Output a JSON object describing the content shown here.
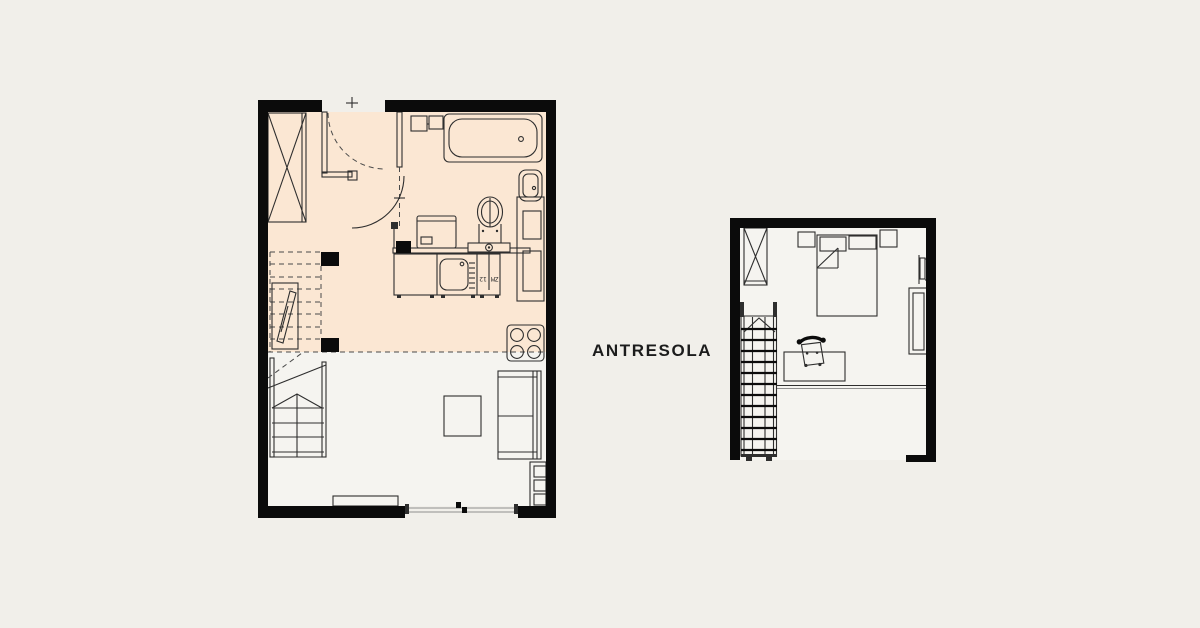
{
  "labels": {
    "mezzanine": "ANTRESOLA",
    "kitchen_unit": "ZM 12"
  },
  "colors": {
    "bg": "#f1efea",
    "wall": "#0b0b0b",
    "peach": "#fbe7d3",
    "room": "#f5f4f0",
    "line": "#2e2e2e",
    "line_light": "#8f8f8f",
    "dash": "#4a4a4a",
    "text": "#1c1c1c"
  }
}
